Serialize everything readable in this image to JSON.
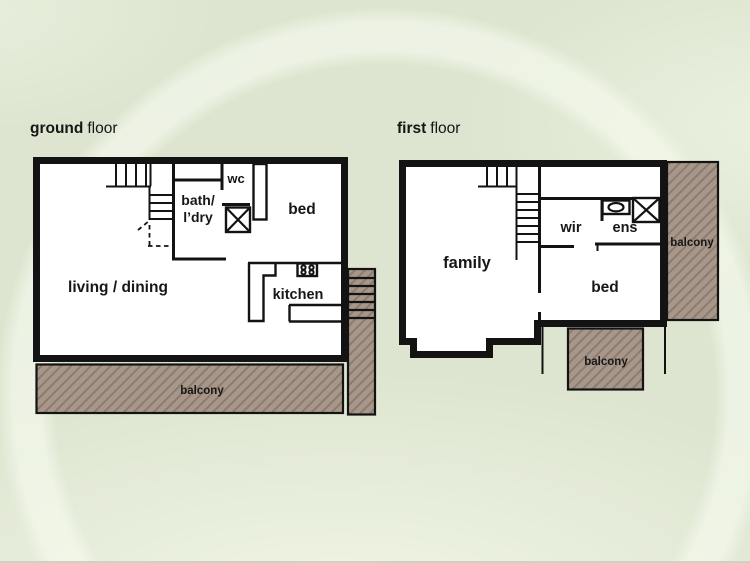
{
  "titles": {
    "ground_bold": "ground",
    "ground_rest": "floor",
    "first_bold": "first",
    "first_rest": "floor"
  },
  "ground_floor": {
    "living": "living / dining",
    "bath_line1": "bath/",
    "bath_line2": "l’dry",
    "wc": "wc",
    "bed": "bed",
    "kitchen": "kitchen",
    "balcony": "balcony"
  },
  "first_floor": {
    "family": "family",
    "wir": "wir",
    "ens": "ens",
    "bed": "bed",
    "balcony_right": "balcony",
    "balcony_bottom": "balcony"
  },
  "colors": {
    "wall": "#131313",
    "text": "#171717",
    "background": "#dde5d0",
    "balcony_fill": "#a7978a",
    "balcony_stripe": "#8d7b6e"
  }
}
